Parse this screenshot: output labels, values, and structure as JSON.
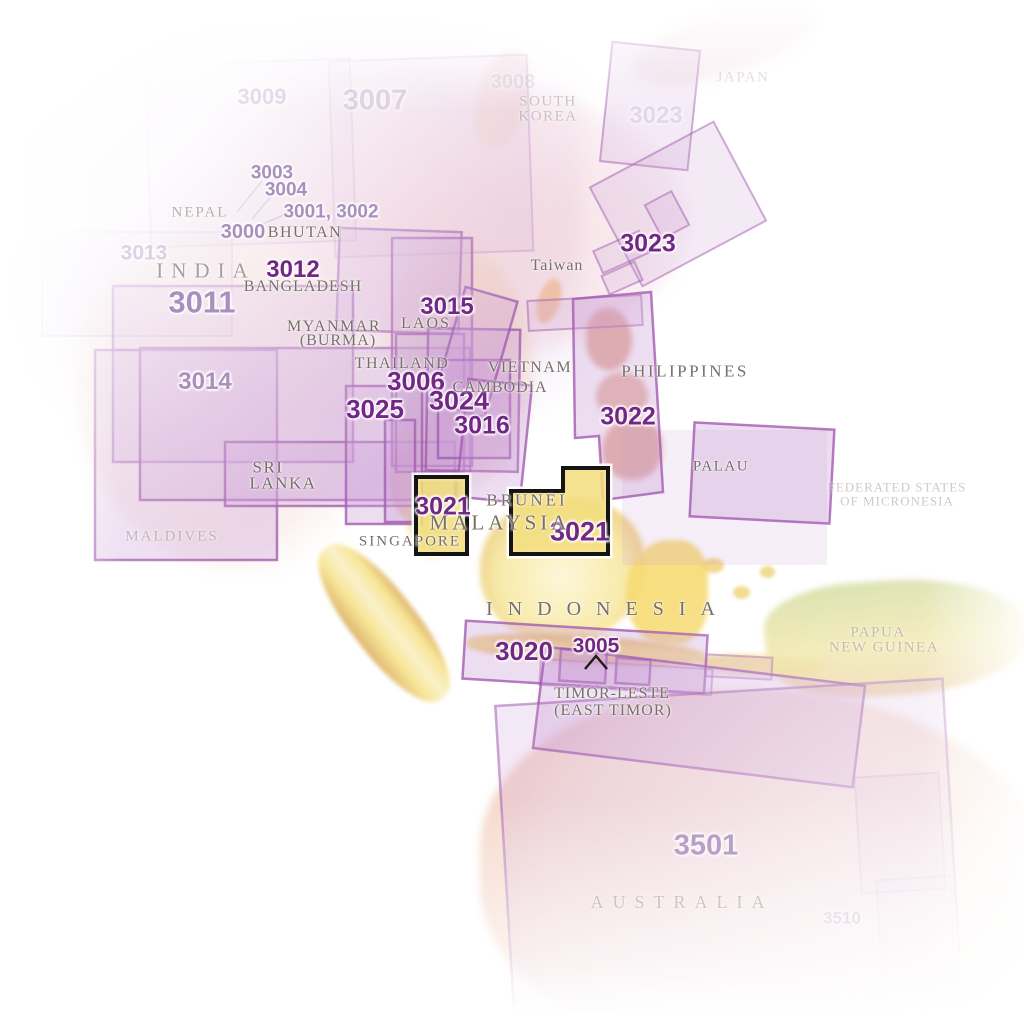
{
  "map": {
    "type": "map-sheet-index",
    "region": "Southeast Asia",
    "highlighted_sheet": "3021"
  },
  "colors": {
    "background": "#ffffff",
    "sheet_number_bold": "#722786",
    "sheet_number_light": "#a98fbe",
    "sheet_number_faint": "#cabbd6",
    "country_label": "#786f68",
    "coverage_box_border": "#a25cb0",
    "coverage_box_fill": "#cda0d7",
    "highlight_box_fill": "#f2dd7c",
    "highlight_box_border": "#141414",
    "terrain_land_pink": "#f2d8d0",
    "terrain_land_yellow": "#f6e28c",
    "terrain_land_green": "#cdd9a0"
  },
  "sheets": {
    "s3009": {
      "text": "3009"
    },
    "s3007": {
      "text": "3007"
    },
    "s3008": {
      "text": "3008"
    },
    "s3023_top": {
      "text": "3023"
    },
    "s3003": {
      "text": "3003"
    },
    "s3004": {
      "text": "3004"
    },
    "s3001_3002": {
      "text": "3001, 3002"
    },
    "s3000": {
      "text": "3000"
    },
    "s3013": {
      "text": "3013"
    },
    "s3012": {
      "text": "3012"
    },
    "s3011": {
      "text": "3011"
    },
    "s3014": {
      "text": "3014"
    },
    "s3015": {
      "text": "3015"
    },
    "s3006": {
      "text": "3006"
    },
    "s3025": {
      "text": "3025"
    },
    "s3024": {
      "text": "3024"
    },
    "s3016": {
      "text": "3016"
    },
    "s3022": {
      "text": "3022"
    },
    "s3023": {
      "text": "3023"
    },
    "s3021_west": {
      "text": "3021"
    },
    "s3021_east": {
      "text": "3021"
    },
    "s3020": {
      "text": "3020"
    },
    "s3005": {
      "text": "3005"
    },
    "s3501": {
      "text": "3501"
    },
    "s3510": {
      "text": "3510"
    }
  },
  "countries": {
    "nepal": {
      "name": "NEPAL"
    },
    "bhutan": {
      "name": "BHUTAN"
    },
    "india": {
      "name": "INDIA"
    },
    "bangladesh": {
      "name": "BANGLADESH"
    },
    "myanmar_1": {
      "name": "MYANMAR"
    },
    "myanmar_2": {
      "name": "(BURMA)"
    },
    "laos": {
      "name": "LAOS"
    },
    "thailand": {
      "name": "THAILAND"
    },
    "vietnam": {
      "name": "VIETNAM"
    },
    "cambodia": {
      "name": "CAMBODIA"
    },
    "philippines": {
      "name": "PHILIPPINES"
    },
    "sri_lanka_1": {
      "name": "SRI"
    },
    "sri_lanka_2": {
      "name": "LANKA"
    },
    "maldives": {
      "name": "MALDIVES"
    },
    "singapore": {
      "name": "SINGAPORE"
    },
    "malaysia": {
      "name": "MALAYSIA"
    },
    "brunei": {
      "name": "BRUNEI"
    },
    "palau": {
      "name": "PALAU"
    },
    "indonesia": {
      "name": "INDONESIA"
    },
    "timor_1": {
      "name": "TIMOR-LESTE"
    },
    "timor_2": {
      "name": "(EAST TIMOR)"
    },
    "png_1": {
      "name": "PAPUA"
    },
    "png_2": {
      "name": "NEW GUINEA"
    },
    "fsm_1": {
      "name": "FEDERATED STATES"
    },
    "fsm_2": {
      "name": "OF MICRONESIA"
    },
    "australia": {
      "name": "AUSTRALIA"
    },
    "south_korea_1": {
      "name": "SOUTH"
    },
    "south_korea_2": {
      "name": "KOREA"
    },
    "taiwan": {
      "name": "Taiwan"
    },
    "japan": {
      "name": "JAPAN"
    }
  }
}
